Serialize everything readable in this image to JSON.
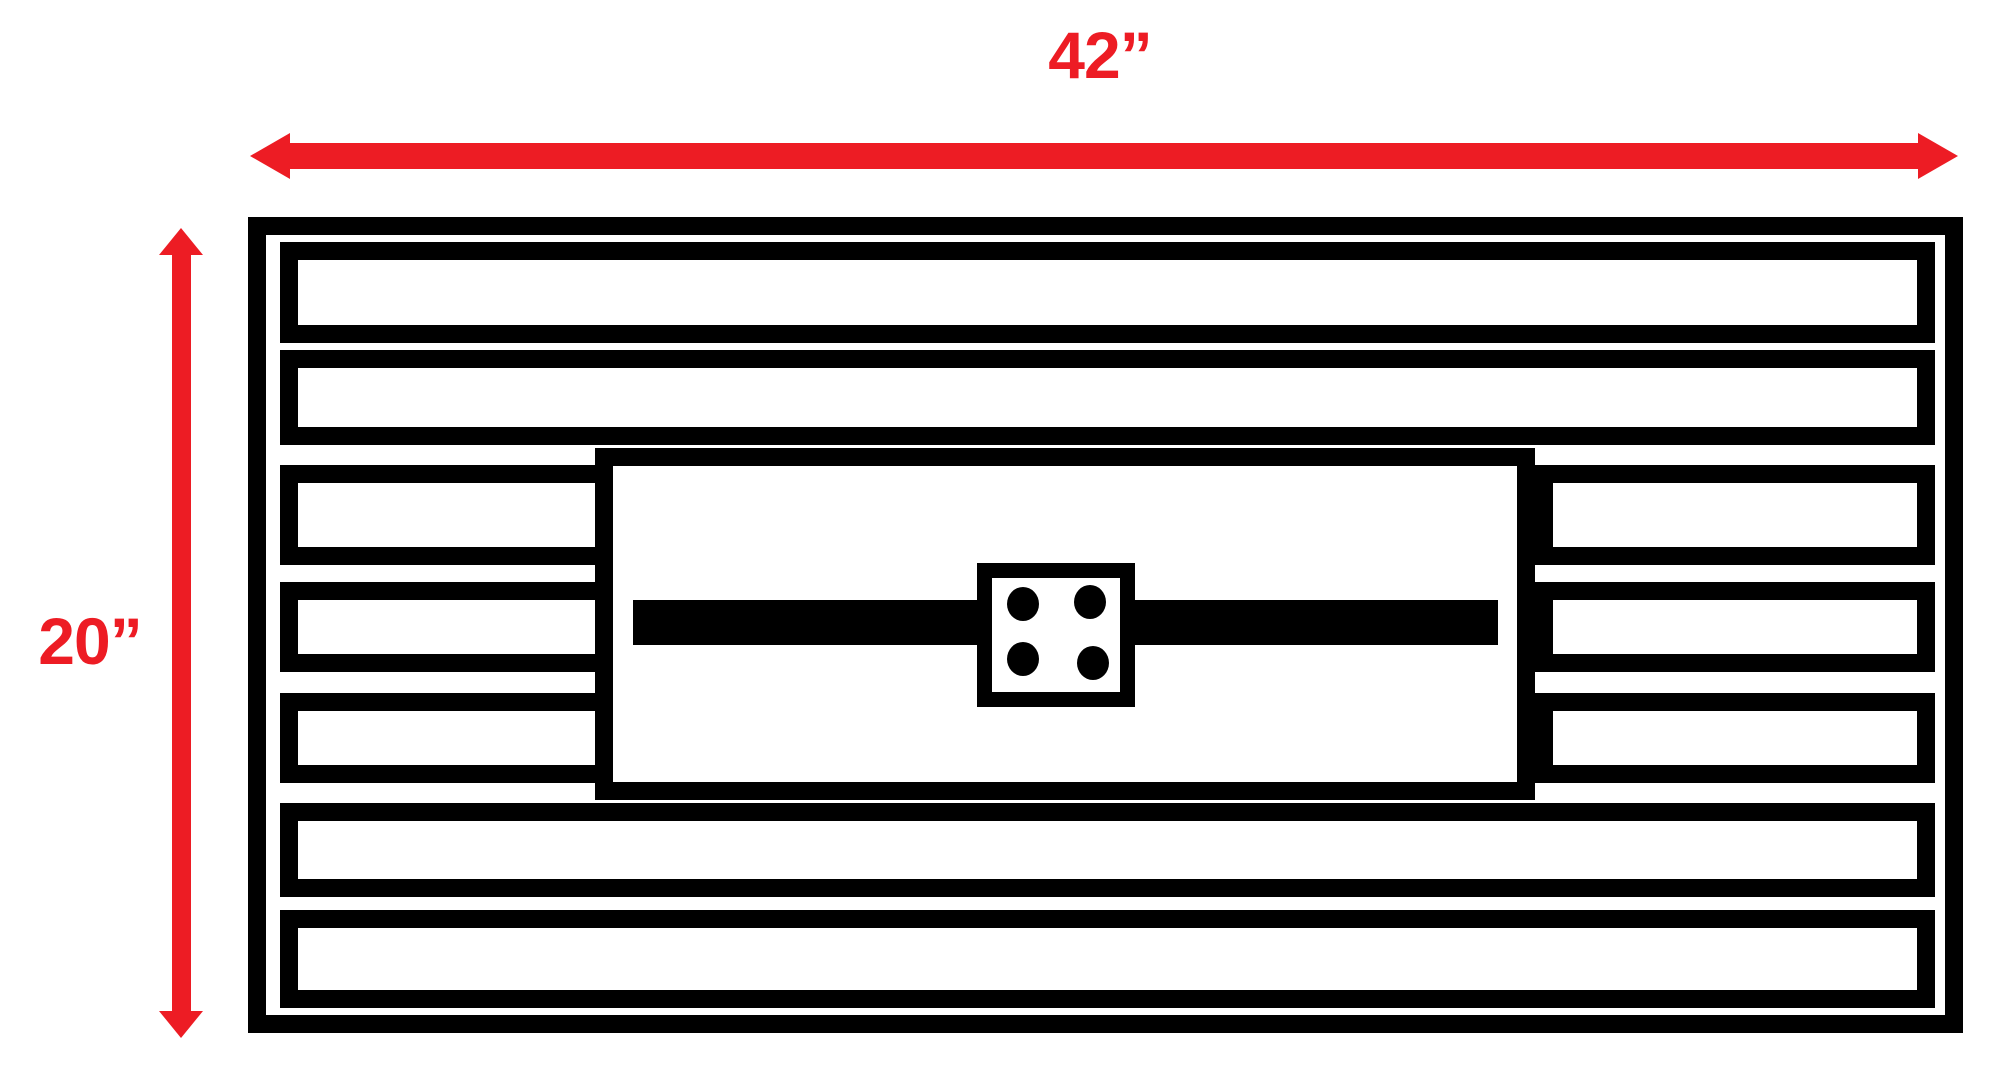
{
  "diagram": {
    "title": "Slatted panel with center burner plate - dimensioned drawing",
    "dimensions": {
      "width_label": "42”",
      "height_label": "20”",
      "width_inches": 42,
      "height_inches": 20
    },
    "colors": {
      "dimension_accent": "#ED1C24",
      "line": "#000000",
      "background": "#FFFFFF"
    },
    "structure": {
      "full_slat_count": 4,
      "short_slat_pairs": 3,
      "total_slat_rows": 7,
      "bolt_count": 4,
      "center_panel": "rectangular plate with horizontal mounting bar and 4-bolt bracket"
    }
  }
}
